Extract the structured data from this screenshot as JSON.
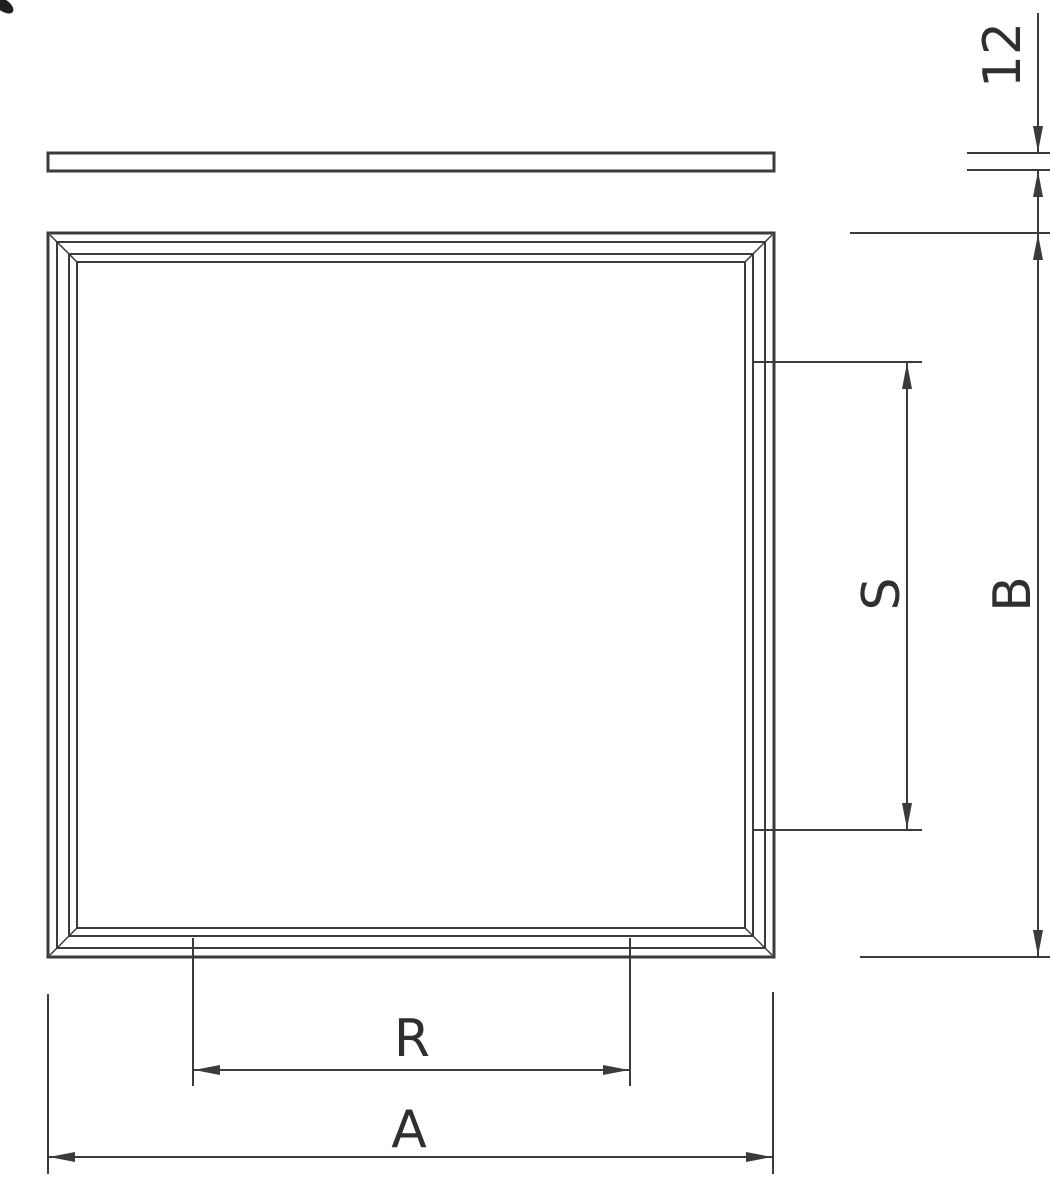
{
  "drawing": {
    "labels": {
      "thickness": "12",
      "overall_height": "B",
      "suspension_spacing": "S",
      "recess_width": "R",
      "overall_width": "A"
    }
  }
}
